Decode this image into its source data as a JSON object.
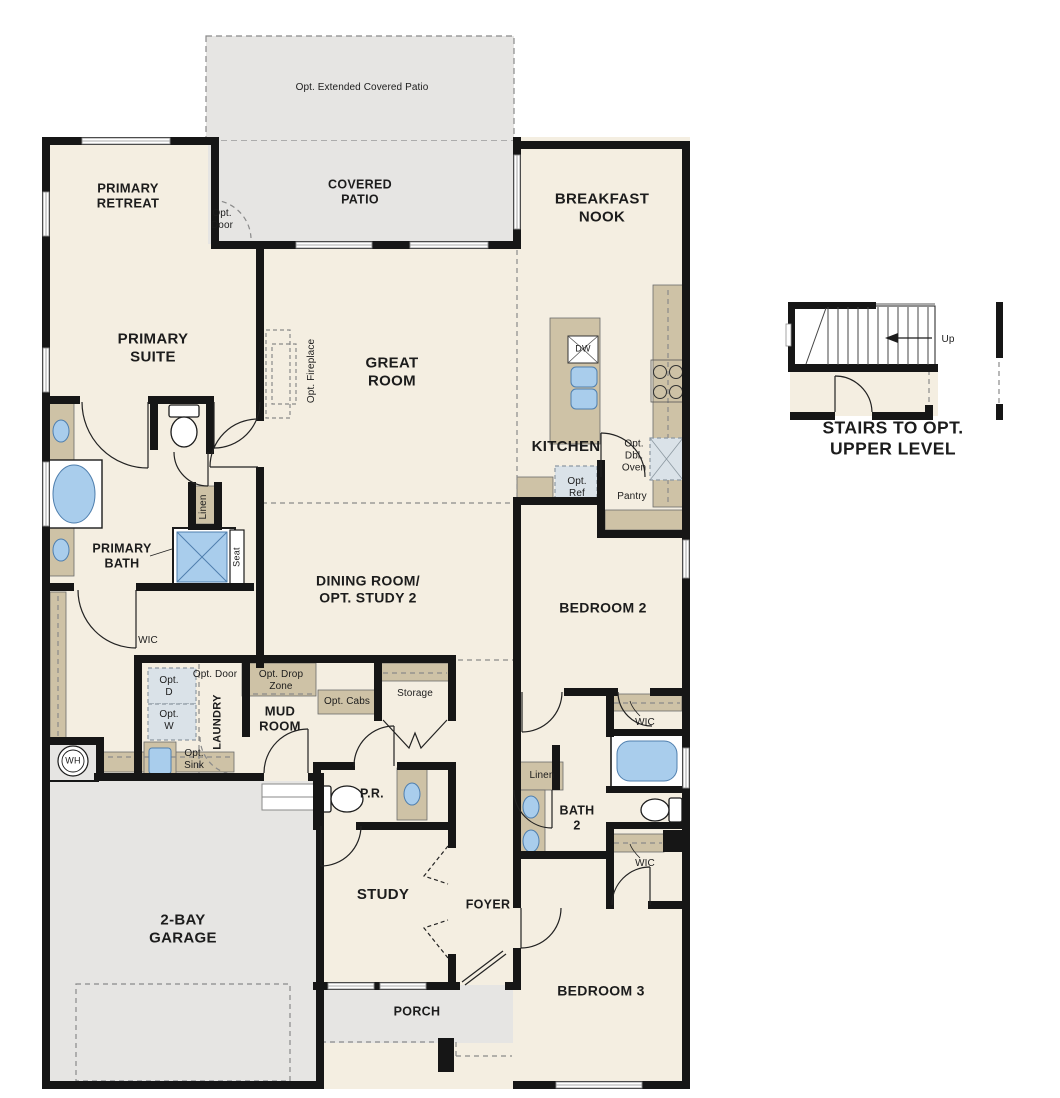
{
  "plan": {
    "type": "single-story-floor-plan",
    "colors": {
      "floor_cream": "#f4eee1",
      "patio_gray": "#e6e5e3",
      "counter_tan": "#cec2a6",
      "fixture_blue": "#a9cdec",
      "optional_appliance": "#dae2e8",
      "wall_black": "#161616",
      "dashed_gray": "#8a8a8a"
    }
  },
  "labels": {
    "opt_extended_covered_patio": "Opt. Extended Covered Patio",
    "covered_patio": "COVERED\nPATIO",
    "opt_door_patio": "Opt.\nDoor",
    "primary_retreat": "PRIMARY\nRETREAT",
    "breakfast_nook": "BREAKFAST\nNOOK",
    "primary_suite": "PRIMARY\nSUITE",
    "great_room": "GREAT\nROOM",
    "opt_fireplace": "Opt. Fireplace",
    "dw": "DW",
    "kitchen": "KITCHEN",
    "opt_dbl_oven": "Opt.\nDbl.\nOven",
    "opt_ref": "Opt.\nRef",
    "pantry": "Pantry",
    "linen_primary": "Linen",
    "primary_bath": "PRIMARY\nBATH",
    "seat": "Seat",
    "dining_room": "DINING ROOM/\nOPT. STUDY 2",
    "bedroom_2": "BEDROOM 2",
    "wic_primary": "WIC",
    "opt_door_laundry": "Opt. Door",
    "opt_drop_zone": "Opt. Drop\nZone",
    "opt_d": "Opt.\nD",
    "opt_w": "Opt.\nW",
    "laundry": "LAUNDRY",
    "mud_room": "MUD\nROOM",
    "opt_cabs": "Opt. Cabs",
    "storage": "Storage",
    "opt_sink": "Opt.\nSink",
    "wh": "WH",
    "pr": "P.R.",
    "wic_bedroom2": "WIC",
    "linen_bath2": "Linen",
    "bath_2": "BATH\n2",
    "wic_bedroom3": "WIC",
    "garage": "2-BAY\nGARAGE",
    "study": "STUDY",
    "foyer": "FOYER",
    "bedroom_3": "BEDROOM 3",
    "porch": "PORCH",
    "up": "Up",
    "stairs_caption": "STAIRS TO OPT. UPPER LEVEL"
  }
}
